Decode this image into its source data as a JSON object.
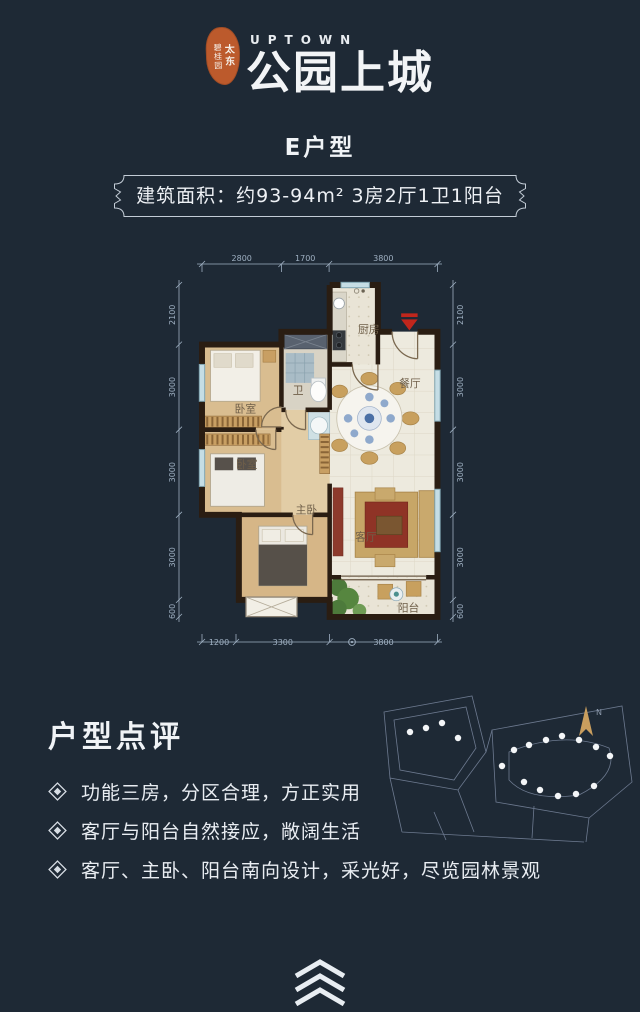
{
  "page": {
    "background": "#1e2935"
  },
  "header": {
    "seal": {
      "line_left": "碧桂园",
      "line_right": "太东",
      "color": "#bc5a2c"
    },
    "brand_en": "UPTOWN",
    "brand_cn": "公园上城"
  },
  "unit": {
    "title": "E户型",
    "spec": "建筑面积：约93-94m²  3房2厅1卫1阳台"
  },
  "floorplan": {
    "dims_top": [
      "2800",
      "1700",
      "3800"
    ],
    "dims_left": [
      "2100",
      "3000",
      "3000",
      "3000",
      "600"
    ],
    "dims_right": [
      "2100",
      "3000",
      "3000",
      "3000",
      "600"
    ],
    "dims_bottom": [
      "1200",
      "3300",
      "3800"
    ],
    "rooms": {
      "kitchen": "厨房",
      "dining": "餐厅",
      "bath": "卫",
      "bedroom1": "卧室",
      "bedroom2": "卧室",
      "master": "主卧",
      "living": "客厅",
      "balcony": "阳台"
    }
  },
  "review": {
    "title": "户型点评",
    "points": [
      "功能三房，分区合理，方正实用",
      "客厅与阳台自然接应，敞阔生活",
      "客厅、主卧、阳台南向设计，采光好，尽览园林景观"
    ]
  },
  "sitemap": {
    "north_label": "N"
  }
}
